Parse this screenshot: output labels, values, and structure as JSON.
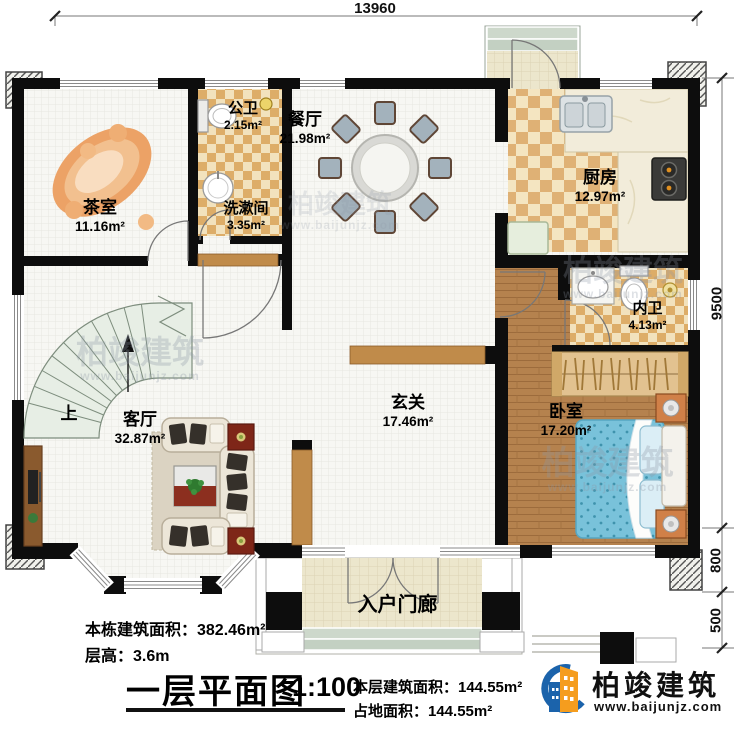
{
  "dimensions": {
    "top": "13960",
    "right": [
      "9500",
      "800",
      "500"
    ]
  },
  "rooms": {
    "tea_room": {
      "name": "茶室",
      "area": "11.16m²"
    },
    "public_bath": {
      "name": "公卫",
      "area": "2.15m²"
    },
    "washroom": {
      "name": "洗漱间",
      "area": "3.35m²"
    },
    "dining": {
      "name": "餐厅",
      "area": "21.98m²"
    },
    "kitchen": {
      "name": "厨房",
      "area": "12.97m²"
    },
    "inner_bath": {
      "name": "内卫",
      "area": "4.13m²"
    },
    "bedroom": {
      "name": "卧室",
      "area": "17.20m²"
    },
    "living": {
      "name": "客厅",
      "area": "32.87m²"
    },
    "foyer": {
      "name": "玄关",
      "area": "17.46m²"
    },
    "porch": {
      "name": "入户门廊"
    }
  },
  "stairs": {
    "up_label": "上"
  },
  "info": {
    "building_area": "本栋建筑面积：382.46m²",
    "floor_height": "层高：3.6m",
    "plan_title": "一层平面图",
    "scale": "1:100",
    "floor_area": "本层建筑面积：144.55m²",
    "footprint_area": "占地面积：144.55m²"
  },
  "brand": {
    "name": "柏竣建筑",
    "url": "www.baijunjz.com"
  },
  "watermark": {
    "name": "柏竣建筑",
    "url": "www.baijunjz.com"
  }
}
